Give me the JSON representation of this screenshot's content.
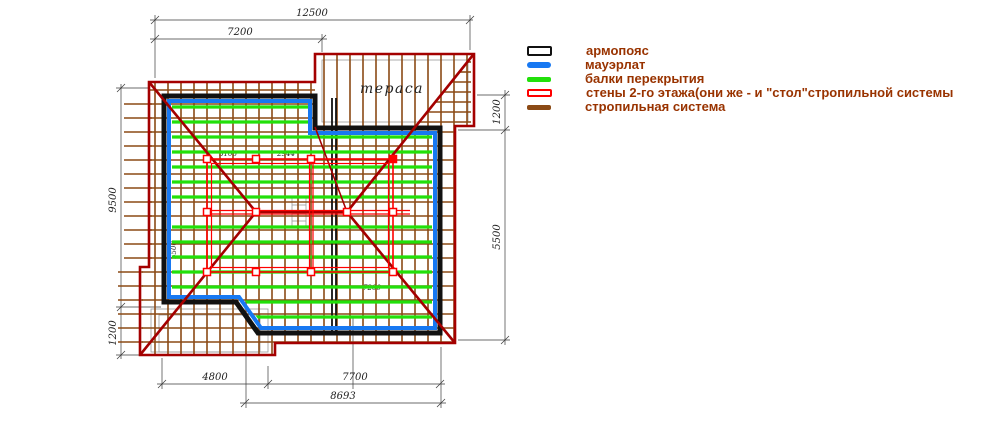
{
  "drawing": {
    "terrace_label": "тераса",
    "dimensions": {
      "top_total": "12500",
      "top_left": "7200",
      "left_main": "9500",
      "left_lower": "1200",
      "right_upper": "1200",
      "right_main": "5500",
      "bottom_left": "4800",
      "bottom_right": "7700",
      "bottom_total": "8693",
      "inner_a": "3106",
      "inner_b": "2944",
      "inner_left": "5500",
      "inner_right": "7200"
    }
  },
  "legend": {
    "items": [
      {
        "label": "армопояс",
        "type": "outline-black"
      },
      {
        "label": "мауэрлат",
        "type": "solid-blue"
      },
      {
        "label": "балки перекрытия",
        "type": "solid-green"
      },
      {
        "label": "стены 2-го этажа(они же -  и \"стол\"стропильной системы",
        "type": "outline-red"
      },
      {
        "label": "стропильная система",
        "type": "solid-brown"
      }
    ]
  },
  "colors": {
    "armopoyas": "#111111",
    "mauerlat": "#1778f2",
    "floor_beams": "#22e00a",
    "walls_2nd_floor": "#ff0000",
    "rafter_system": "#8b4a15",
    "roof_outline": "#a40000",
    "legend_text": "#993300"
  }
}
